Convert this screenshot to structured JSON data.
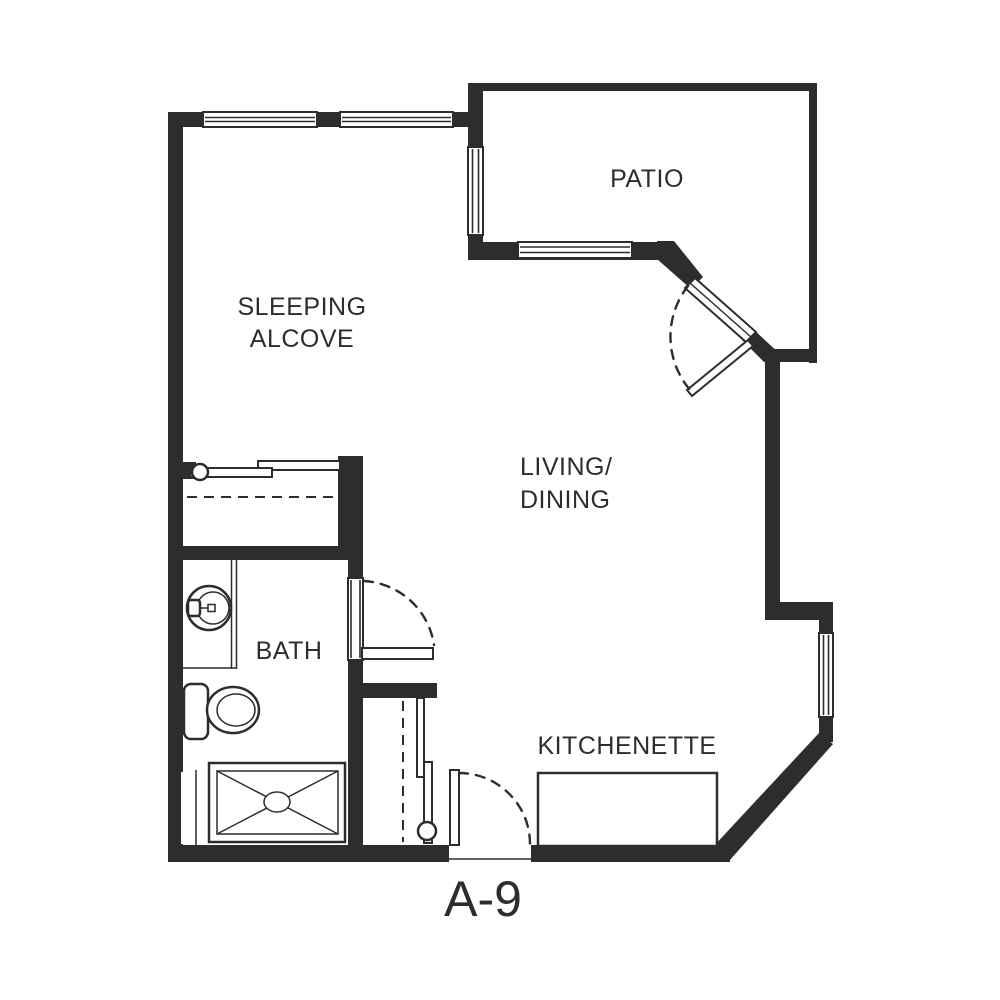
{
  "plan": {
    "title": "A-9",
    "labels": {
      "patio": "PATIO",
      "sleeping_line1": "SLEEPING",
      "sleeping_line2": "ALCOVE",
      "living_line1": "LIVING/",
      "living_line2": "DINING",
      "bath": "BATH",
      "kitchenette": "KITCHENETTE"
    },
    "colors": {
      "wall": "#2d2d2d",
      "background": "#ffffff"
    },
    "fixtures": [
      "bypass-closet-doors",
      "wardrobe-shelf",
      "vanity-sink",
      "toilet",
      "shower-pan",
      "kitchenette-counter",
      "entry-swing-door",
      "bath-swing-door",
      "patio-swing-door",
      "windows"
    ]
  }
}
